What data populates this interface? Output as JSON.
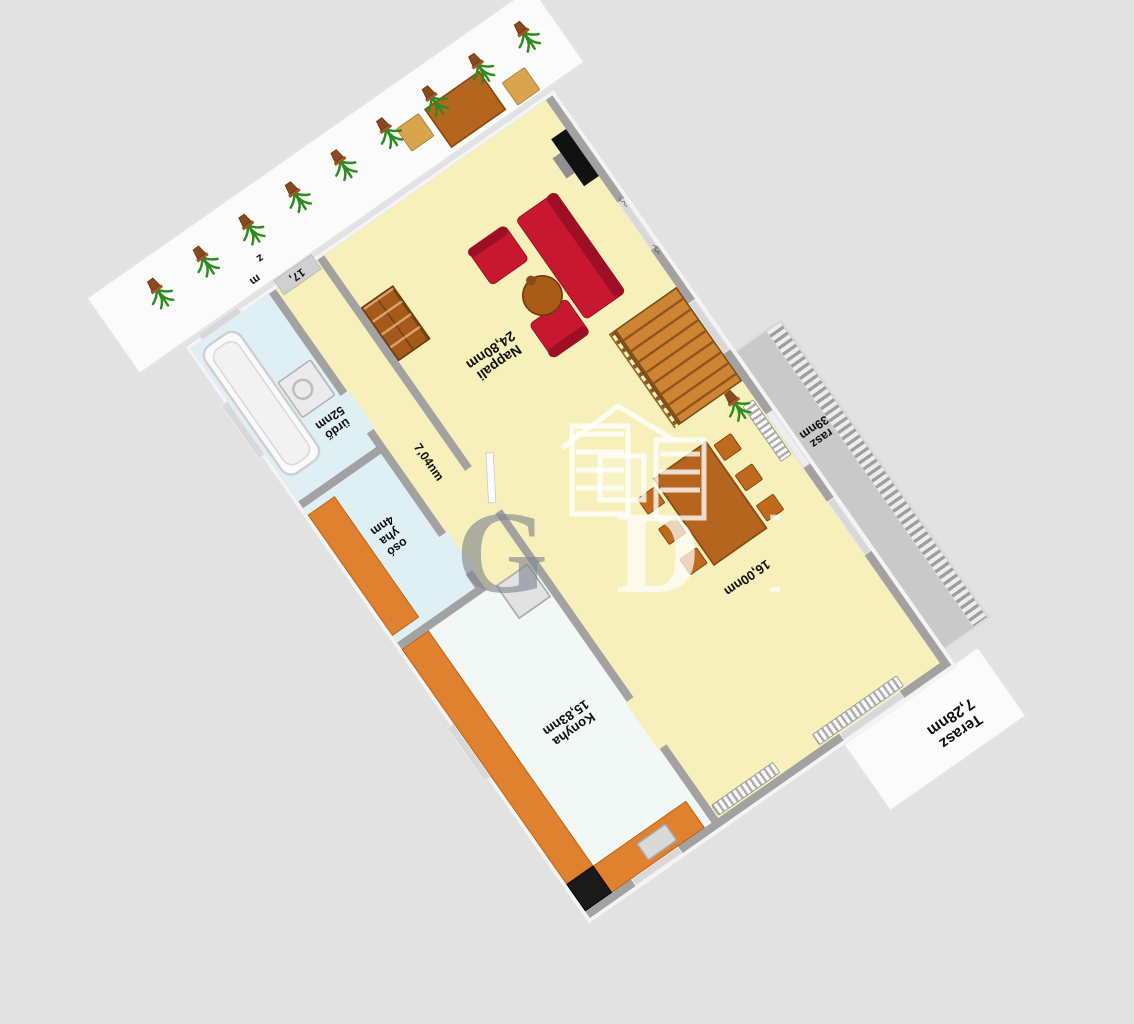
{
  "watermark": {
    "letter_1": "G",
    "letter_2": "D",
    "letter_3": "N",
    "icon": "house-outline-icon"
  },
  "rooms": {
    "living": {
      "name": "Nappali",
      "area": "24,80nm"
    },
    "dining": {
      "area": "16,00nm"
    },
    "hallway": {
      "area": "7,04nm"
    },
    "kitchen": {
      "name": "Konyha",
      "area": "15,83nm"
    },
    "bathroom": {
      "name_fragment": "ürdő",
      "area_fragment": "52nm"
    },
    "laundry": {
      "fragment_1": "osó",
      "fragment_2": "yha",
      "fragment_3": "4nm"
    },
    "balcony": {
      "name_fragment": "rasz",
      "area_fragment": "39nm"
    },
    "terrace_main": {
      "name": "Terasz",
      "area": "7,28nm"
    },
    "entry": {
      "door_label": "17,",
      "stray_fragment_1": "m",
      "stray_fragment_2": "z"
    }
  },
  "furniture": {
    "terrace_plants": [
      1,
      2,
      3,
      4,
      5,
      6,
      7,
      8,
      9
    ],
    "dining_chair_count": 6,
    "sofa_count": 3
  },
  "colors": {
    "background": "#e2e2e2",
    "wall_gray": "#a2a2a2",
    "floor_living_yellow": "#f7f0bb",
    "floor_wet_blue": "#dff0f4",
    "floor_kitchen_white": "#f2f8f6",
    "counter_orange": "#e0812f",
    "sofa_red": "#c81830",
    "wood_brown": "#b5651d",
    "plant_green": "#2e8b1e",
    "watermark_gray": "#7d868e"
  }
}
